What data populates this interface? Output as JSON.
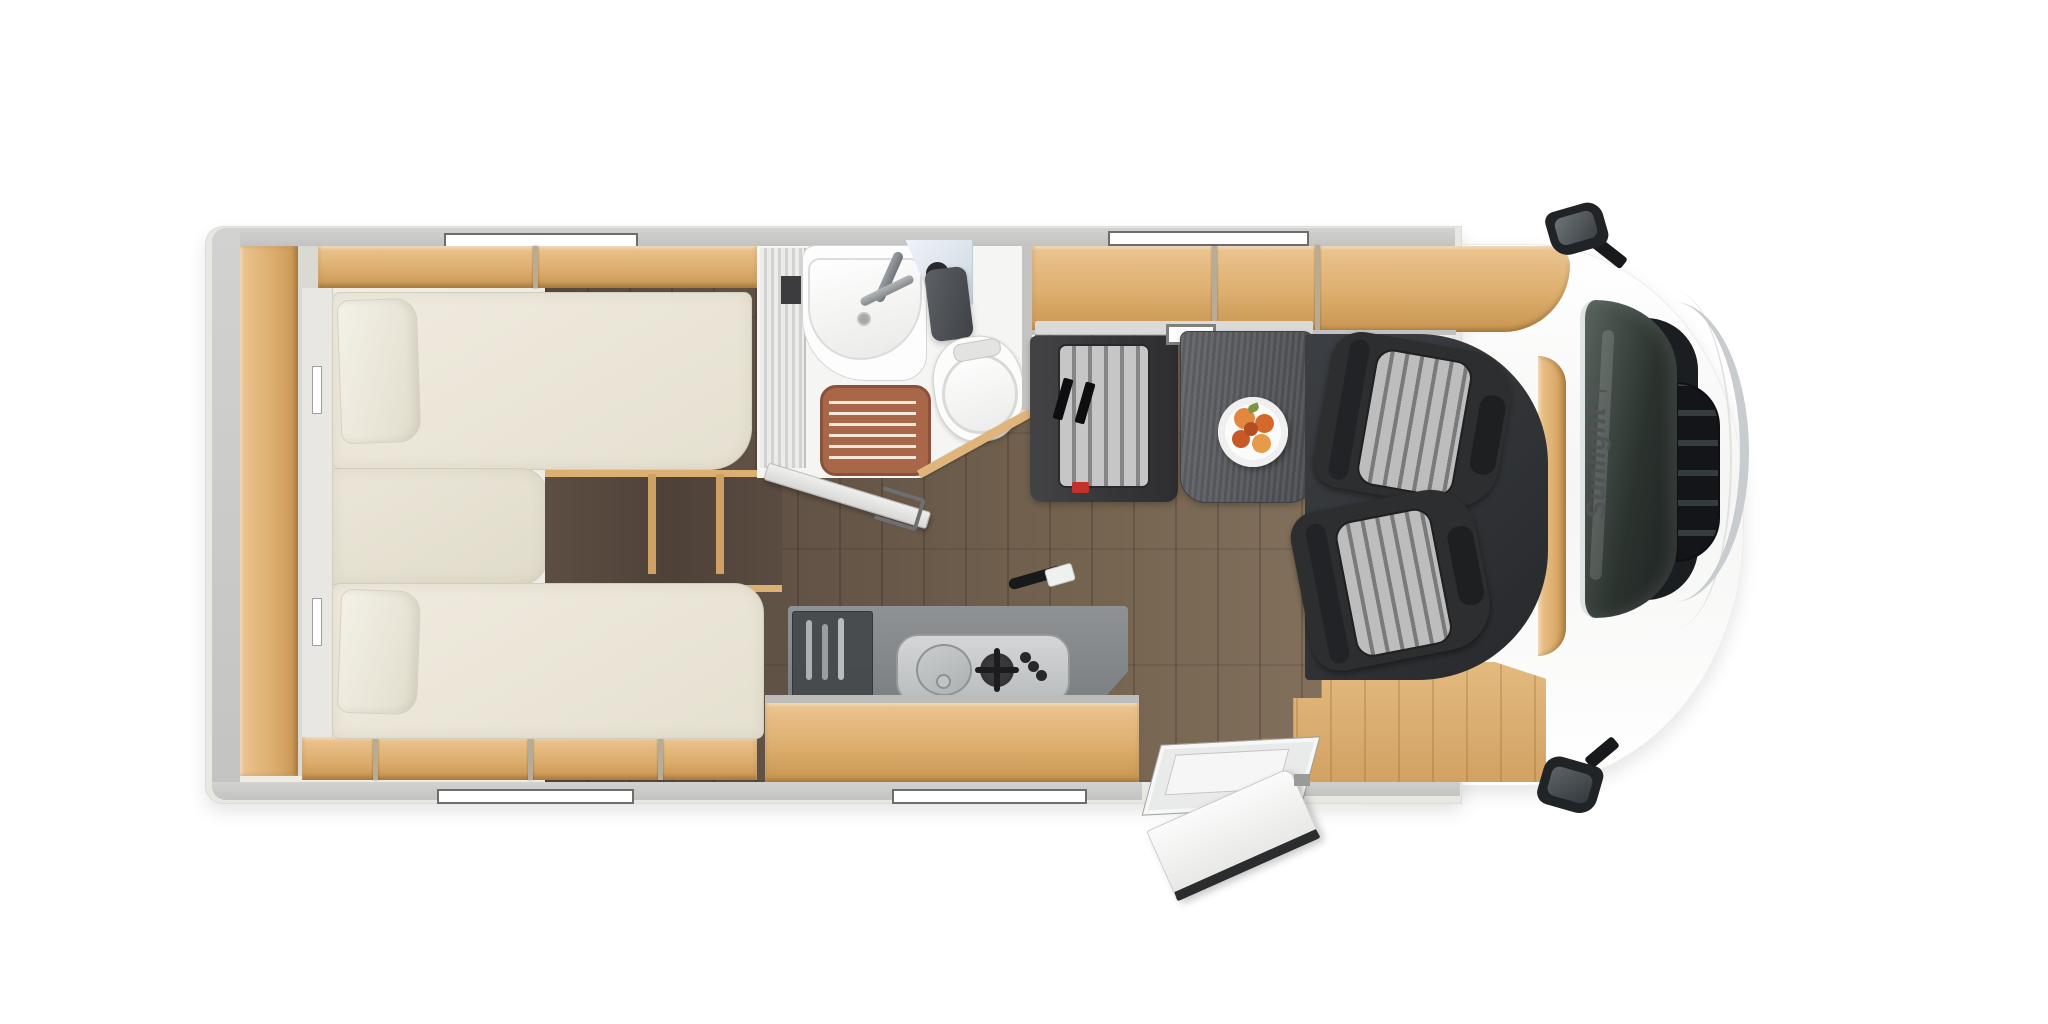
{
  "brand": {
    "logo_text": "Sunlight"
  },
  "icons": {
    "brand_mark": "palm-tree-icon"
  },
  "palette": {
    "background": "#ffffff",
    "wall_gray": "#c8c8c6",
    "interior_cream": "#efece4",
    "mattress": "#e9e5d8",
    "wood_light": "#e0b57c",
    "wood_front": "#ddb174",
    "dark_shelf": "#57493f",
    "floor_dark": "#55483e",
    "floor_light": "#83705e",
    "bath_white": "#f5f5f3",
    "shower_mat": "#a9674a",
    "counter": "#9aa0a2",
    "drawer": "#4b5054",
    "bench_dark": "#3a3a3c",
    "stripe_a": "#c6c6c6",
    "stripe_b": "#858585",
    "table": "#57595d",
    "seat_dark": "#2c2e30",
    "cab_dark": "#34373b",
    "glass_dark": "#242a27",
    "grille": "#131518",
    "chrome": "#c7cccf",
    "mirror_dark": "#212427",
    "fruit_a": "#e2883e",
    "fruit_b": "#d4692c",
    "fruit_c": "#c85a28",
    "fruit_d": "#e79a4a",
    "leaf": "#7a9440",
    "logo": "#515256",
    "red_accent": "#c1322a"
  }
}
